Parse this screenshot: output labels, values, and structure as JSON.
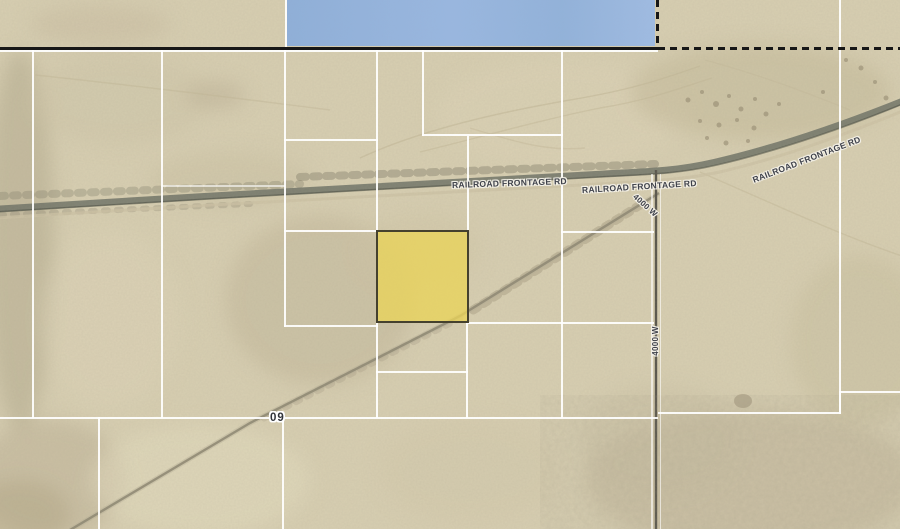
{
  "map": {
    "road_labels": [
      {
        "id": "railroad-frontage-rd-1",
        "text": "RAILROAD FRONTAGE RD"
      },
      {
        "id": "railroad-frontage-rd-2",
        "text": "RAILROAD FRONTAGE RD"
      },
      {
        "id": "railroad-frontage-rd-3",
        "text": "RAILROAD FRONTAGE RD"
      },
      {
        "id": "4000-w-upper",
        "text": "4000 W"
      },
      {
        "id": "4000-w-lower",
        "text": "4000 W"
      }
    ],
    "section_label": {
      "text": "09"
    },
    "highlighted_parcel": {
      "fill_color": "#E9D45A",
      "border_color": "#45412E"
    },
    "blue_parcel_overlay": {
      "fill_color": "#93B3DC"
    },
    "colors": {
      "terrain": "#D8CFB2",
      "parcel_line": "#FFFFFF",
      "section_boundary": "#171717",
      "railroad": "#6F7266",
      "dirt_road": "#97907C",
      "label_text": "#3E414A"
    }
  }
}
